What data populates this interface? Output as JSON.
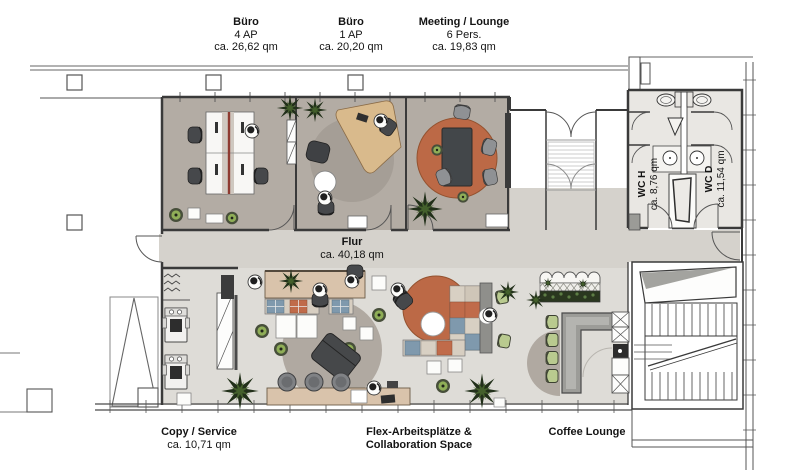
{
  "plan_labels": {
    "top_rooms": [
      {
        "name": "Büro",
        "capacity": "4 AP",
        "area": "ca. 26,62 qm"
      },
      {
        "name": "Büro",
        "capacity": "1 AP",
        "area": "ca. 20,20 qm"
      },
      {
        "name": "Meeting / Lounge",
        "capacity": "6 Pers.",
        "area": "ca. 19,83 qm"
      }
    ],
    "corridor": {
      "name": "Flur",
      "area": "ca. 40,18 qm"
    },
    "wc": [
      {
        "name": "WC H",
        "area": "ca. 8,76 qm"
      },
      {
        "name": "WC D",
        "area": "ca. 11,54 qm"
      }
    ],
    "bottom_rooms": [
      {
        "name": "Copy / Service",
        "area": "ca. 10,71 qm"
      },
      {
        "name": "Flex-Arbeitsplätze &",
        "name2": "Collaboration Space"
      },
      {
        "name": "Coffee Lounge"
      }
    ]
  },
  "colors": {
    "office_floor": "#b3aca4",
    "corridor_floor": "#d5d2cc",
    "flex_floor": "#dedcd7",
    "wc_floor": "#e9e7e3",
    "wall": "#3a3a3a",
    "terracotta_rug": "#bc6946",
    "wood_desk": "#d9ba8c",
    "wood_counter": "#d9c3ab",
    "rug_gray": "#b0a9a1",
    "plant_green": "#8fae57",
    "chair_green": "#b9ca8f",
    "cushion_blue": "#7f99ad",
    "cushion_orange": "#c06b4a"
  }
}
